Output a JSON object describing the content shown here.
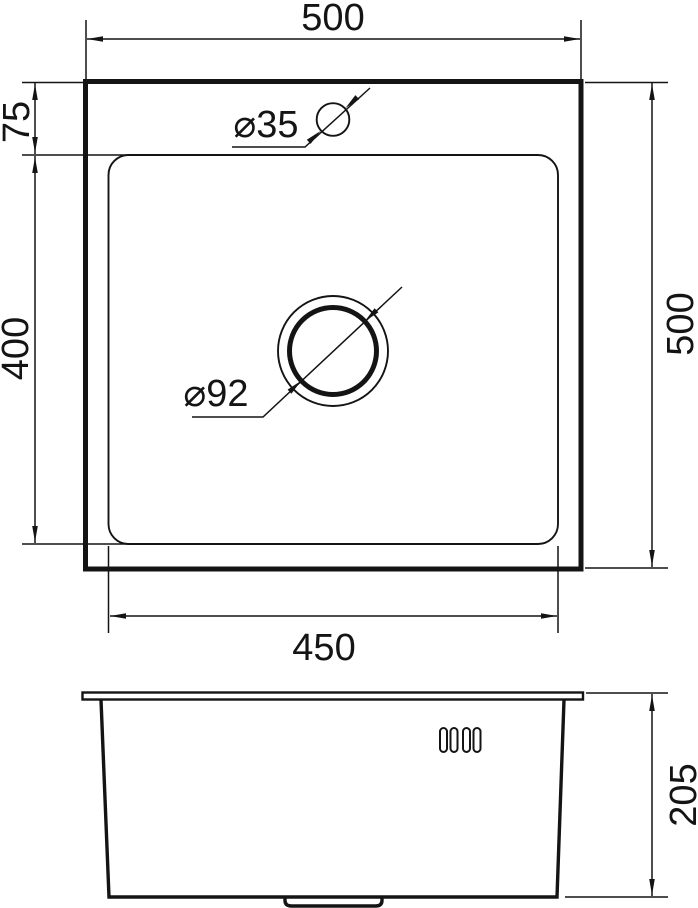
{
  "top_view": {
    "overall_width": "500",
    "overall_depth": "500",
    "faucet_offset": "75",
    "bowl_depth": "400",
    "bowl_width": "450",
    "faucet_hole_diameter": "⌀35",
    "drain_diameter": "⌀92"
  },
  "side_view": {
    "height": "205"
  },
  "colors": {
    "line": "#141414",
    "background": "#ffffff"
  }
}
